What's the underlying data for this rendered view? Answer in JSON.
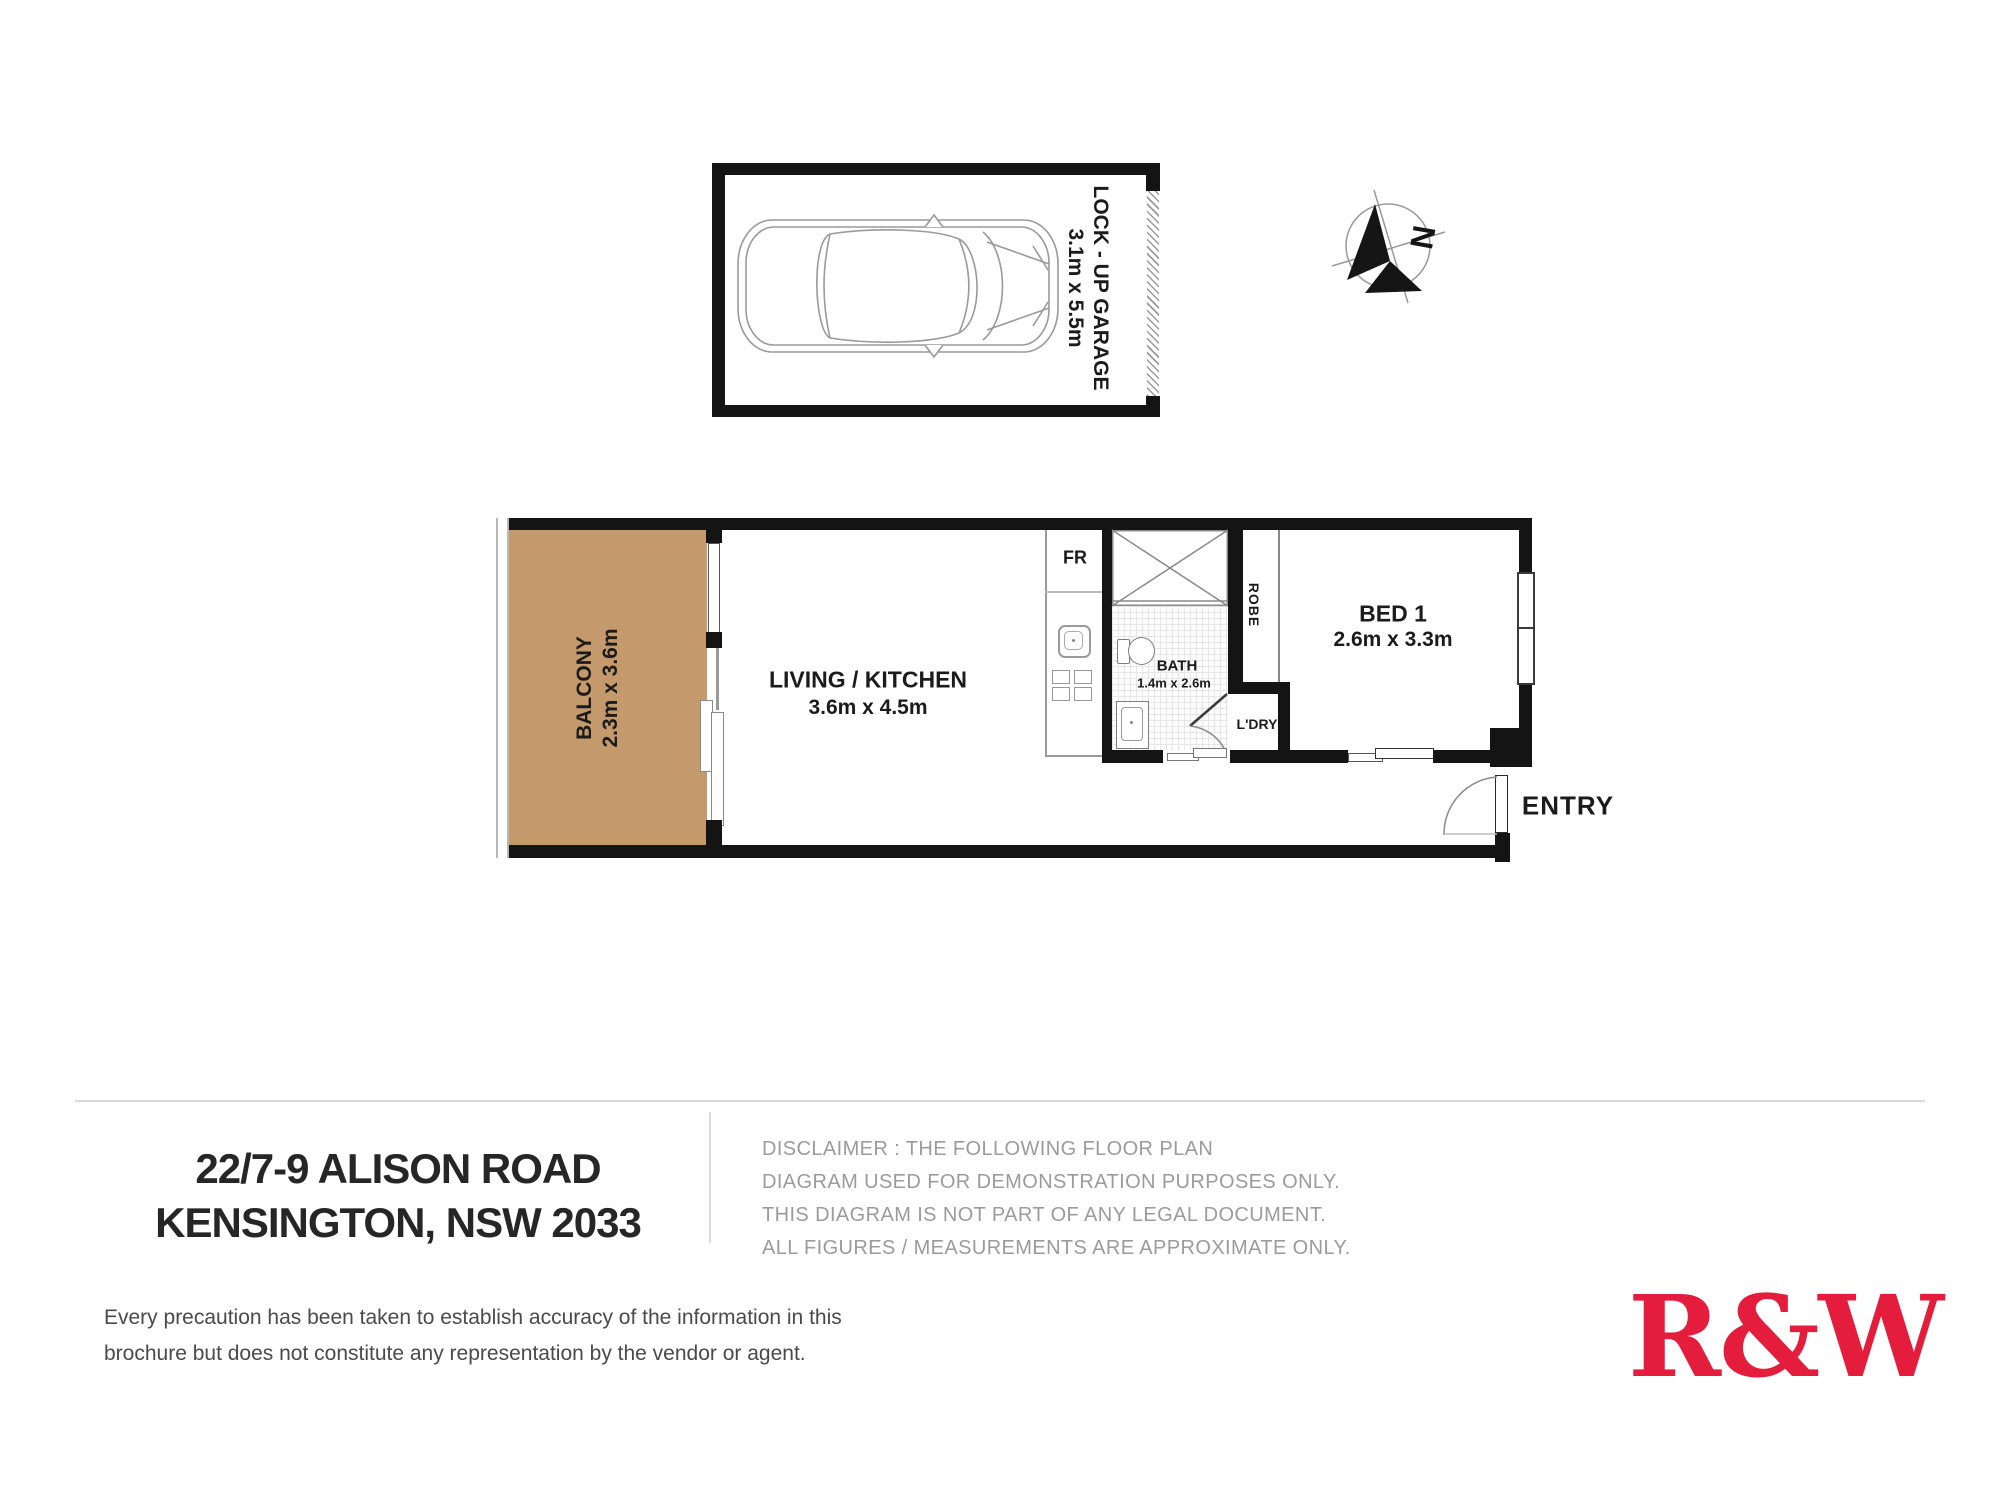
{
  "plan": {
    "garage": {
      "label": "LOCK - UP GARAGE",
      "dims": "3.1m x 5.5m"
    },
    "compass": {
      "north_label": "N"
    },
    "rooms": {
      "balcony": {
        "label": "BALCONY",
        "dims": "2.3m x 3.6m"
      },
      "living": {
        "label": "LIVING / KITCHEN",
        "dims": "3.6m x 4.5m"
      },
      "bath": {
        "label": "BATH",
        "dims": "1.4m x 2.6m"
      },
      "bed1": {
        "label": "BED 1",
        "dims": "2.6m x 3.3m"
      },
      "robe": {
        "label": "ROBE"
      },
      "laundry": {
        "label": "L'DRY"
      },
      "fridge": {
        "label": "FR"
      },
      "entry": {
        "label": "ENTRY"
      }
    }
  },
  "footer": {
    "address_line1": "22/7-9 ALISON ROAD",
    "address_line2": "KENSINGTON, NSW 2033",
    "disclaimer": [
      "DISCLAIMER : THE FOLLOWING FLOOR PLAN",
      "DIAGRAM USED FOR DEMONSTRATION PURPOSES ONLY.",
      "THIS DIAGRAM IS NOT PART OF ANY LEGAL DOCUMENT.",
      "ALL FIGURES / MEASUREMENTS ARE APPROXIMATE ONLY."
    ],
    "fine_print": [
      "Every precaution has been taken to establish accuracy of the information in this",
      "brochure but does not constitute any representation by the vendor or agent."
    ],
    "logo_text": "R&W"
  },
  "colors": {
    "wall": "#141414",
    "balcony_fill": "#c49a6c",
    "logo_red": "#e41d3d",
    "disclaimer_gray": "#9b9b9b"
  }
}
